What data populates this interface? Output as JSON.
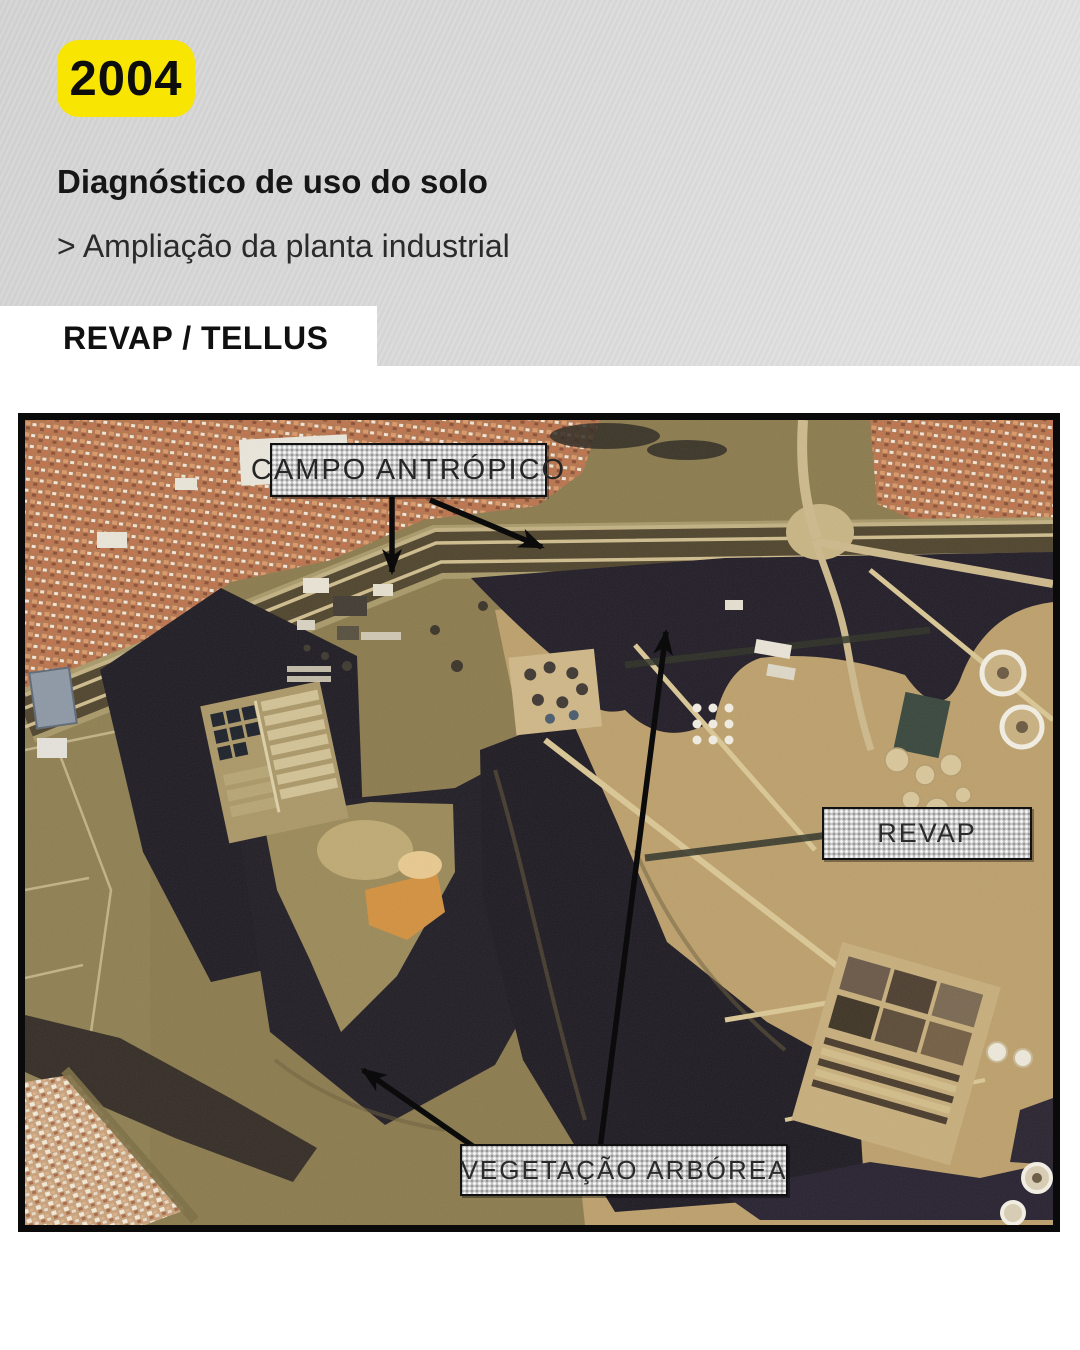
{
  "slide": {
    "year_badge": "2004",
    "title": "Diagnóstico de uso do solo",
    "subtitle": "> Ampliação da planta industrial",
    "source_label": "REVAP / TELLUS"
  },
  "map": {
    "labels": {
      "campo_antropico": "CAMPO ANTRÓPICO",
      "revap": "REVAP",
      "vegetacao_arborea": "VEGETAÇÃO ARBÓREA"
    },
    "arrows": [
      {
        "from": "campo_antropico",
        "points_to": "grass field below highway"
      },
      {
        "from": "campo_antropico",
        "points_to": "roadside field to the right"
      },
      {
        "from": "vegetacao_arborea",
        "points_to": "tree band below highway"
      },
      {
        "from": "vegetacao_arborea",
        "points_to": "large forest patch"
      }
    ]
  },
  "colors": {
    "badge_yellow": "#f8e501",
    "header_gray": "#d9d9d9",
    "label_box_gray": "#c6c6c6",
    "photo_border_black": "#0a0a0a",
    "forest_dark": "#201c24",
    "field_olive": "#8c7b4e",
    "industrial_tan": "#bda06c",
    "roof_red": "#b5764f"
  }
}
